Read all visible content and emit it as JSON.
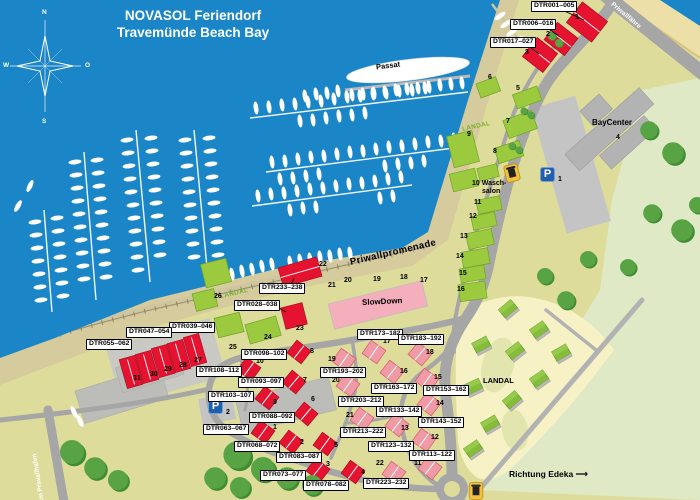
{
  "title": {
    "brand": "NOVASOL",
    "rest": " Feriendorf",
    "line2": "Travemünde Beach Bay"
  },
  "compass": {
    "n": "N",
    "e": "O",
    "s": "S",
    "w": "W"
  },
  "ship": "Passat",
  "roads": {
    "promenade": "Priwallpromenade",
    "harbor": "Am Priwallhafen",
    "ferry": "Priwallfähre"
  },
  "poi": {
    "baycenter": "BayCenter",
    "slowdown": "SlowDown",
    "laundry_num": "10",
    "laundry1": "Wasch-",
    "laundry2": "salon",
    "landal": "LANDAL",
    "direction": "Richtung Edeka",
    "arrow": "⟶"
  },
  "parking": {
    "p": "P",
    "n1": "1",
    "n2": "2"
  },
  "colors": {
    "water": "#1a86c8",
    "land": "#dedc9b",
    "red": "#e5132f",
    "green_building": "#9bca3e",
    "accent_blue": "#1f5fae"
  },
  "units": [
    "DTR001–005",
    "DTR006–016",
    "DTR017–027",
    "DTR233–238",
    "DTR028–038",
    "DTR039–046",
    "DTR047–054",
    "DTR055–062",
    "DTR108–112",
    "DTR103–107",
    "DTR098–102",
    "DTR093–097",
    "DTR088–092",
    "DTR063–067",
    "DTR068–072",
    "DTR083–087",
    "DTR073–077",
    "DTR078–082",
    "DTR173–182",
    "DTR183–192",
    "DTR193–202",
    "DTR163–172",
    "DTR153–162",
    "DTR203–212",
    "DTR133–142",
    "DTR143–152",
    "DTR213–222",
    "DTR123–132",
    "DTR113–122",
    "DTR223–232"
  ],
  "nums": [
    "1",
    "2",
    "3",
    "4",
    "5",
    "6",
    "7",
    "8",
    "9",
    "11",
    "12",
    "13",
    "14",
    "15",
    "16",
    "17",
    "18",
    "19",
    "20",
    "21",
    "22",
    "23",
    "24",
    "25",
    "26",
    "27",
    "28",
    "29",
    "30",
    "31",
    "1",
    "2",
    "3",
    "4",
    "5",
    "6",
    "7",
    "8",
    "9",
    "10",
    "11",
    "12",
    "13",
    "14",
    "15",
    "16",
    "17",
    "18",
    "19",
    "20",
    "21",
    "22"
  ]
}
